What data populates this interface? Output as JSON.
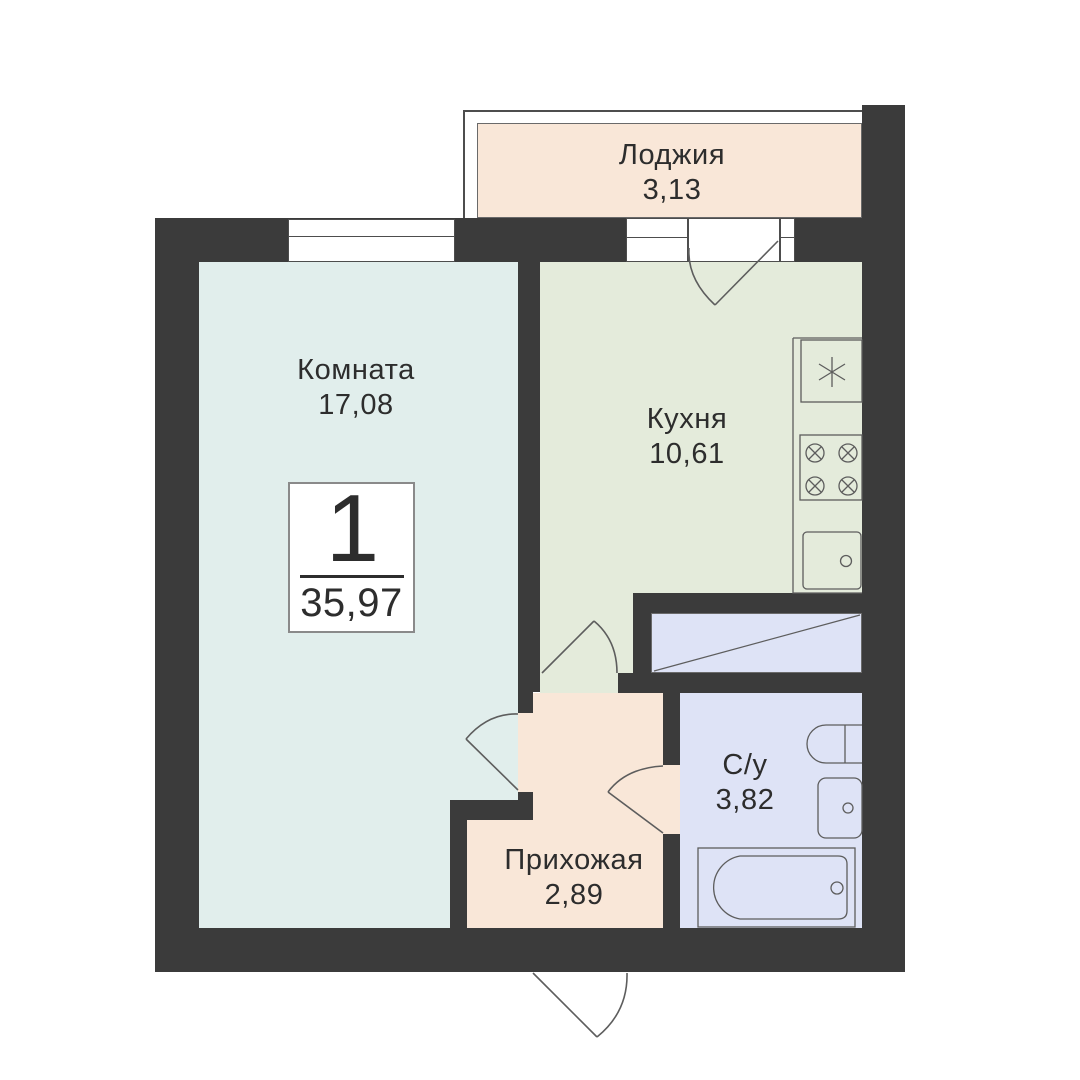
{
  "plan": {
    "title": "apartment-floor-plan",
    "unit": {
      "number": "1",
      "total_area": "35,97"
    },
    "rooms": [
      {
        "id": "loggia",
        "name": "Лоджия",
        "area": "3,13"
      },
      {
        "id": "room",
        "name": "Комната",
        "area": "17,08"
      },
      {
        "id": "kitchen",
        "name": "Кухня",
        "area": "10,61"
      },
      {
        "id": "bathroom",
        "name": "С/у",
        "area": "3,82"
      },
      {
        "id": "hallway",
        "name": "Прихожая",
        "area": "2,89"
      }
    ],
    "fixtures": [
      "kitchen-sink",
      "stove-4-burners",
      "washer",
      "toilet",
      "bath-sink",
      "bathtub"
    ],
    "colors": {
      "wall": "#3b3b3b",
      "room_fill": "#e1eeec",
      "kitchen_fill": "#e4ebdb",
      "loggia_fill": "#f9e7d8",
      "hallway_fill": "#f9e7d8",
      "bathroom_fill": "#dee3f6",
      "closet_fill": "#dee3f6",
      "outline": "#5d5d5d",
      "text": "#2d2d2d",
      "background": "#ffffff"
    }
  }
}
